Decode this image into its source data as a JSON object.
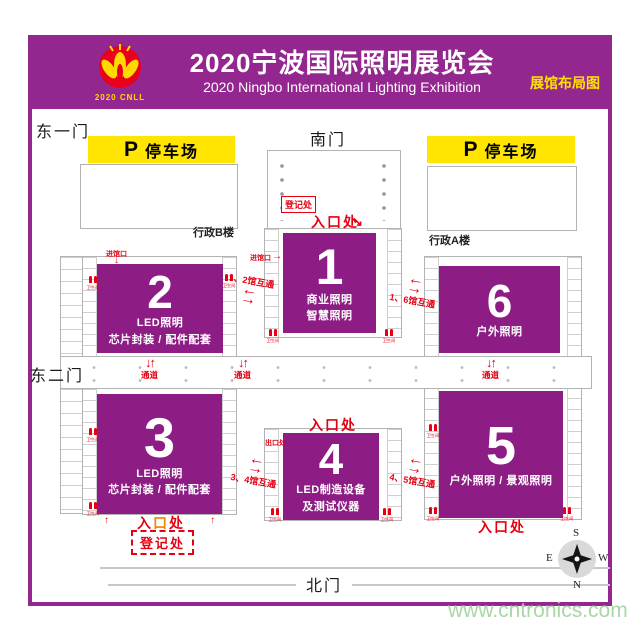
{
  "header": {
    "logo_caption": "2020 CNLL",
    "title": "2020宁波国际照明展览会",
    "subtitle": "2020 Ningbo International Lighting Exhibition",
    "corner_label": "展馆布局图"
  },
  "gates": {
    "east1": "东一门",
    "south": "南门",
    "east2": "东二门",
    "north": "北门"
  },
  "parking": {
    "p": "P",
    "label": "停车场"
  },
  "buildings": {
    "admin_b": "行政B楼",
    "admin_a": "行政A楼"
  },
  "halls": [
    {
      "num": "1",
      "line1": "商业照明",
      "line2": "智慧照明"
    },
    {
      "num": "2",
      "line1": "LED照明",
      "line2": "芯片封装 / 配件配套"
    },
    {
      "num": "3",
      "line1": "LED照明",
      "line2": "芯片封装 / 配件配套"
    },
    {
      "num": "4",
      "line1": "LED制造设备",
      "line2": "及测试仪器"
    },
    {
      "num": "5",
      "line1": "户外照明 / 景观照明",
      "line2": ""
    },
    {
      "num": "6",
      "line1": "户外照明",
      "line2": ""
    }
  ],
  "labels": {
    "registration": "登记处",
    "entrance": "入口处",
    "entrance_char1": "入",
    "entrance_char2": "口",
    "entrance_char3": "处",
    "passage": "通道",
    "restroom": "卫生间",
    "hall_gate": "进馆口",
    "exit": "出口处",
    "interconnect_12": "1、2馆互通",
    "interconnect_16": "1、6馆互通",
    "interconnect_34": "3、4馆互通",
    "interconnect_45": "4、5馆互通"
  },
  "compass": {
    "n": "N",
    "s": "S",
    "e": "E",
    "w": "W"
  },
  "watermark": "www.cntronics.com",
  "colors": {
    "banner_purple": "#93278f",
    "hall_purple": "#8d1c84",
    "parking_yellow": "#ffe500",
    "accent_red": "#e60012",
    "corner_yellow": "#ffe100",
    "watermark_green": "#a9d6a9"
  }
}
